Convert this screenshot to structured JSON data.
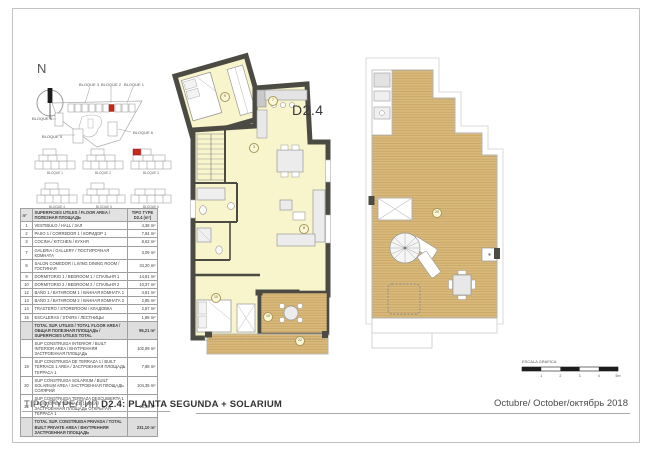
{
  "page": {
    "title_prefix": "TIPO/TYPE/ТИП",
    "title_main": "D2.4: PLANTA SEGUNDA + SOLARIUM",
    "date": "Octubre/ October/октябрь 2018",
    "plan_label": "D2.4",
    "north_label": "N",
    "scale_label": "ESCALA GRAFICA",
    "scale_ticks": [
      "1",
      "2",
      "3",
      "4",
      "5m"
    ]
  },
  "colors": {
    "wall": "#4b4b44",
    "room": "#f8f4cc",
    "deck": "#d9ba7c",
    "deck_line": "#c5a05e",
    "accent": "#c6281e"
  },
  "site_plan": {
    "labels": {
      "b1": "BLOQUE 1",
      "b2": "BLOQUE 2",
      "b3": "BLOQUE 3",
      "b4": "BLOQUE 4",
      "b5": "BLOQUE 5",
      "b6": "BLOQUE 6"
    },
    "elevation_labels": [
      "BLOQUE 1",
      "BLOQUE 2",
      "BLOQUE 3",
      "BLOQUE 4",
      "BLOQUE 5",
      "BLOQUE 6"
    ]
  },
  "area_table": {
    "header": {
      "col_no": "nº",
      "col_desc": "SUPERFICIES UTILES / FLOOR AREA / ПОЛЕЗНАЯ ПЛОЩАДЬ",
      "col_value": "TIPO TYPE D2.4 (m²)"
    },
    "rows": [
      {
        "no": "1",
        "label": "VESTIBULO / HALL / ЗАЛ",
        "value": "4,38 m²"
      },
      {
        "no": "2",
        "label": "PASO 1 / CORREDOR 1 / КОРИДОР 1",
        "value": "7,84 m²"
      },
      {
        "no": "3",
        "label": "COCINA / KITCHEN / КУХНЯ",
        "value": "8,62 m²"
      },
      {
        "no": "7",
        "label": "GALERIA / GALLERY / ПОСТИРОЧНАЯ КОМНАТА",
        "value": "3,09 m²"
      },
      {
        "no": "8",
        "label": "SALON COMEDOR / LIVING DINING ROOM / ГОСТИНАЯ",
        "value": "34,20 m²"
      },
      {
        "no": "9",
        "label": "DORMITORIO 1 / BEDROOM 1 / СПАЛЬНЯ 1",
        "value": "14,81 m²"
      },
      {
        "no": "10",
        "label": "DORMITORIO 2 / BEDROOM 2 / СПАЛЬНЯ 2",
        "value": "10,37 m²"
      },
      {
        "no": "12",
        "label": "BAÑO 1 / BATHROOM 1 / ВАННАЯ КОМНАТА 1",
        "value": "4,81 m²"
      },
      {
        "no": "13",
        "label": "BAÑO 2 / BATHROOM 2 / ВАННАЯ КОМНАТА 2",
        "value": "2,85 m²"
      },
      {
        "no": "14",
        "label": "TRASTERO / STOREROOM / КЛАДОВКА",
        "value": "2,57 m²"
      },
      {
        "no": "15",
        "label": "ESCALERAS / STAIRS / ЛЕСТНИЦЫ",
        "value": "1,85 m²"
      },
      {
        "no": "",
        "label": "TOTAL SUP. UTILES / TOTAL FLOOR AREA / ОБЩАЯ ПОЛЕЗНАЯ ПЛОЩАДЬ / SUPERFICIES UTILES TOTAL",
        "value": "95,21 m²",
        "total": true
      },
      {
        "no": "",
        "label": "SUP CONSTRUIDA INTERIOR / BUILT INTERIOR AREA / ВНУТРЕННЯЯ ЗАСТРОЕННАЯ ПЛОЩАДЬ",
        "value": "102,99 m²"
      },
      {
        "no": "19",
        "label": "SUP CONSTRUIDA DE TERRAZA 1 / BUILT TERRACE 1 AREA / ЗАСТРОЕННАЯ ПЛОЩАДЬ ТЕРРАСА 1",
        "value": "7,88 m²"
      },
      {
        "no": "20",
        "label": "SUP CONSTRUIDA SOLARIUM / BUILT SOLARIUM AREA / ЗАСТРОЕННАЯ ПЛОЩАДЬ СОЛЯРИЙ",
        "value": "104,35 m²"
      },
      {
        "no": "22",
        "label": "SUP CONSTRUIDA TERRAZA DESCUBIERTA 1 / BUILT OPEN TERRACE 1 AREA / ЗАСТРОЕННАЯ ПЛОЩАДЬ ОТКРЫТАЯ ТЕРРАСА 1",
        "value": "15,88 m²"
      },
      {
        "no": "",
        "label": "TOTAL SUP. CONSTRUIDA PRIVADA / TOTAL BUILT PRIVATE AREA / ВНУТРЕННЯЯ ЗАСТРОЕННАЯ ПЛОЩАДЬ",
        "value": "231,10 m²",
        "total": true
      }
    ]
  },
  "plan_markers": [
    {
      "label": "9",
      "x": 224,
      "y": 96
    },
    {
      "label": "7",
      "x": 272,
      "y": 100
    },
    {
      "label": "3",
      "x": 253,
      "y": 147
    },
    {
      "label": "8",
      "x": 303,
      "y": 228
    },
    {
      "label": "10",
      "x": 215,
      "y": 297
    },
    {
      "label": "19",
      "x": 267,
      "y": 316
    },
    {
      "label": "22",
      "x": 299,
      "y": 340
    },
    {
      "label": "20",
      "x": 436,
      "y": 212
    }
  ]
}
